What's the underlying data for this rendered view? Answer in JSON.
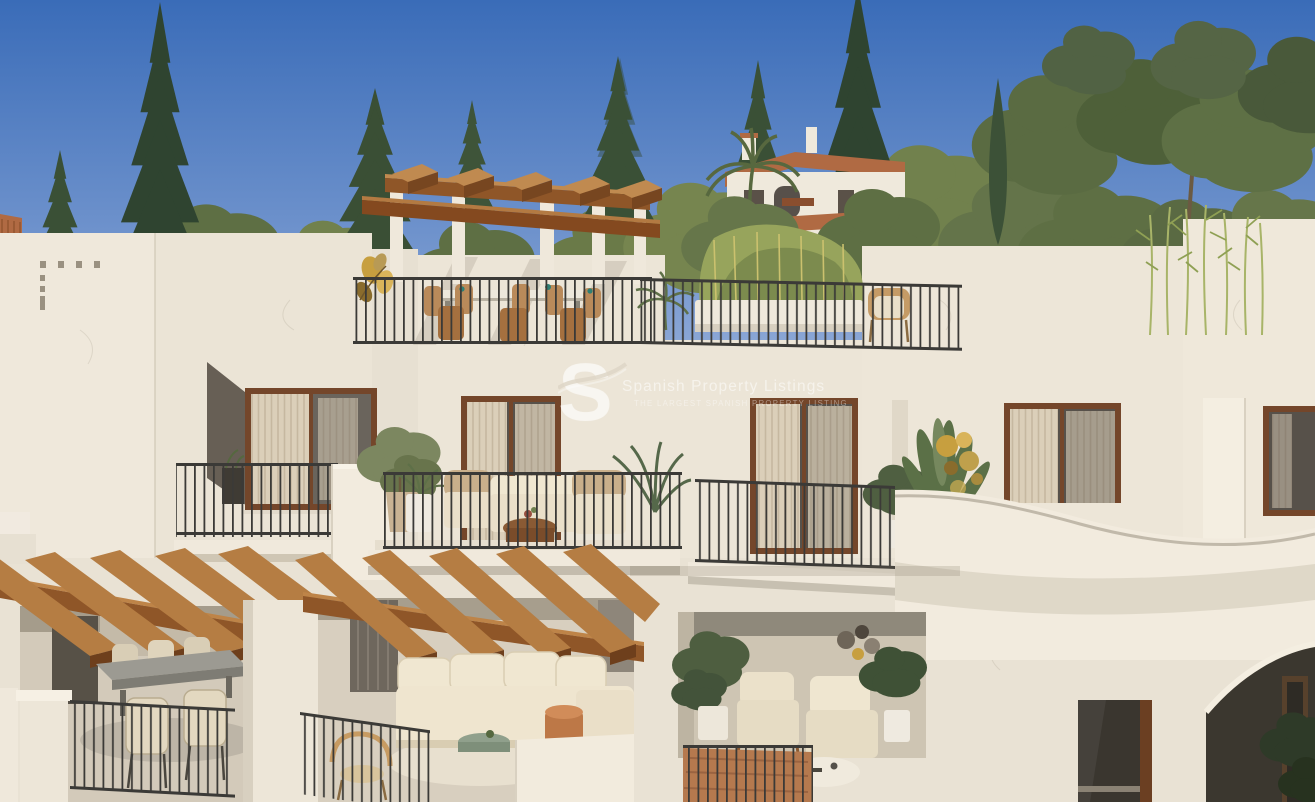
{
  "watermark": {
    "logo_letter": "S",
    "title": "Spanish Property Listings",
    "subtitle": "THE LARGEST SPANISH PROPERTY LISTING",
    "color": "#FFFFFF"
  },
  "palette": {
    "sky_top": "#3E6FB9",
    "sky_horizon": "#9DB4DC",
    "foliage_dark": "#2F4430",
    "foliage_mid": "#55683F",
    "foliage_olive": "#6F7C4B",
    "foliage_light": "#97A45C",
    "wall": "#ECE5D7",
    "wall_bright": "#F4EEE2",
    "wall_shadow": "#D9D1C1",
    "recess_dark": "#4A463D",
    "wood_light": "#C08A50",
    "wood_mid": "#8F5628",
    "wood_dark": "#6B3F1E",
    "window_frame": "#74462A",
    "curtain": "#DBCFB9",
    "railing": "#3B3A37",
    "cushion": "#E7DDC6",
    "terracotta": "#C17B4B",
    "gold_decor": "#C79F3F",
    "teal_accent": "#2E7F74"
  }
}
